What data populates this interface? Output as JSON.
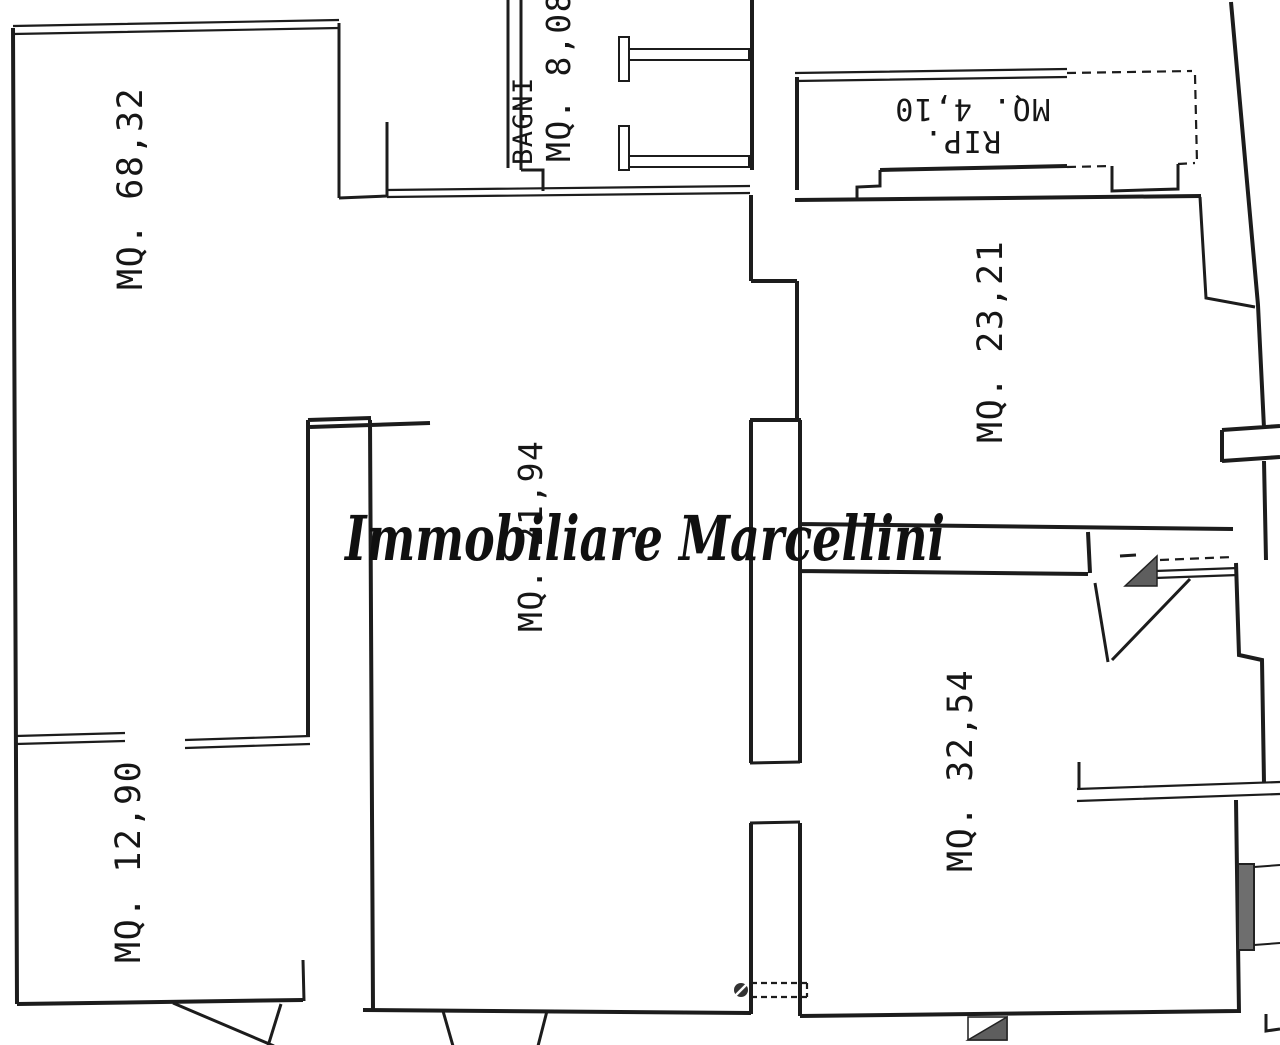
{
  "watermark": {
    "text": "Immobiliare Marcellini"
  },
  "labels": {
    "room_large": "MQ. 68,32",
    "bagni_name": "BAGNI",
    "bagni_area": "MQ. 8,08",
    "rip_name": "RIP.",
    "rip_area": "MQ. 4,10",
    "room_right": "MQ. 23,21",
    "corridor": "MQ. 21,94",
    "room_bottom_right": "MQ. 32,54",
    "room_bottom_left": "MQ. 12,90"
  },
  "colors": {
    "ink": "#1c1c1c",
    "shade_fill": "#5e5e5e",
    "background": "#ffffff"
  }
}
